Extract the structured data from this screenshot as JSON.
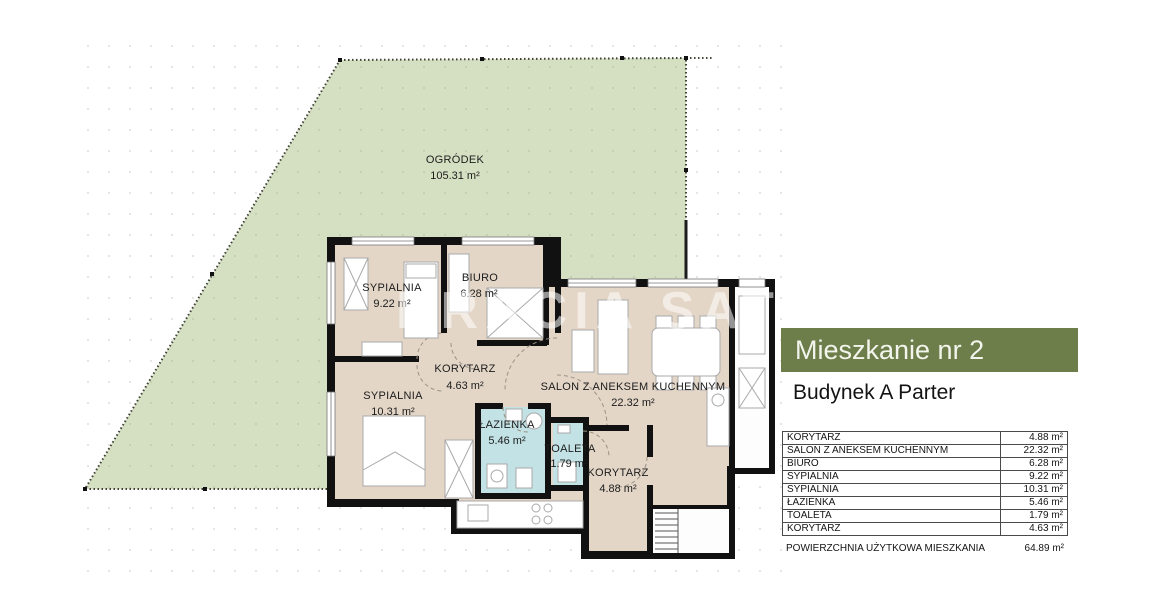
{
  "plan": {
    "garden": {
      "name": "OGRÓDEK",
      "area": "105.31 m²"
    },
    "rooms": [
      {
        "name": "SYPIALNIA",
        "area": "9.22 m²"
      },
      {
        "name": "BIURO",
        "area": "6.28 m²"
      },
      {
        "name": "KORYTARZ",
        "area": "4.63 m²"
      },
      {
        "name": "SYPIALNIA",
        "area": "10.31 m²"
      },
      {
        "name": "ŁAZIENKA",
        "area": "5.46 m²"
      },
      {
        "name": "TOALETA",
        "area": "1.79 m²"
      },
      {
        "name": "SALON Z ANEKSEM KUCHENNYM",
        "area": "22.32 m²"
      },
      {
        "name": "KORYTARZ",
        "area": "4.88 m²"
      }
    ],
    "watermark": "BRACIA SATURSCY"
  },
  "panel": {
    "title": "Mieszkanie nr 2",
    "subtitle": "Budynek A Parter",
    "table": {
      "rows": [
        {
          "label": "KORYTARZ",
          "value": "4.88 m²"
        },
        {
          "label": "SALON Z ANEKSEM KUCHENNYM",
          "value": "22.32 m²"
        },
        {
          "label": "BIURO",
          "value": "6.28 m²"
        },
        {
          "label": "SYPIALNIA",
          "value": "9.22 m²"
        },
        {
          "label": "SYPIALNIA",
          "value": "10.31 m²"
        },
        {
          "label": "ŁAZIENKA",
          "value": "5.46 m²"
        },
        {
          "label": "TOALETA",
          "value": "1.79 m²"
        },
        {
          "label": "KORYTARZ",
          "value": "4.63 m²"
        }
      ],
      "footer": {
        "label": "POWIERZCHNIA UŻYTKOWA MIESZKANIA",
        "value": "64.89 m²"
      }
    }
  },
  "colors": {
    "header_green": "#6d7e4b",
    "garden_green": "#d5e0c3",
    "room_beige": "#e3d6c7",
    "wet_room_blue": "#c2e2e5",
    "wall_black": "#111111"
  }
}
